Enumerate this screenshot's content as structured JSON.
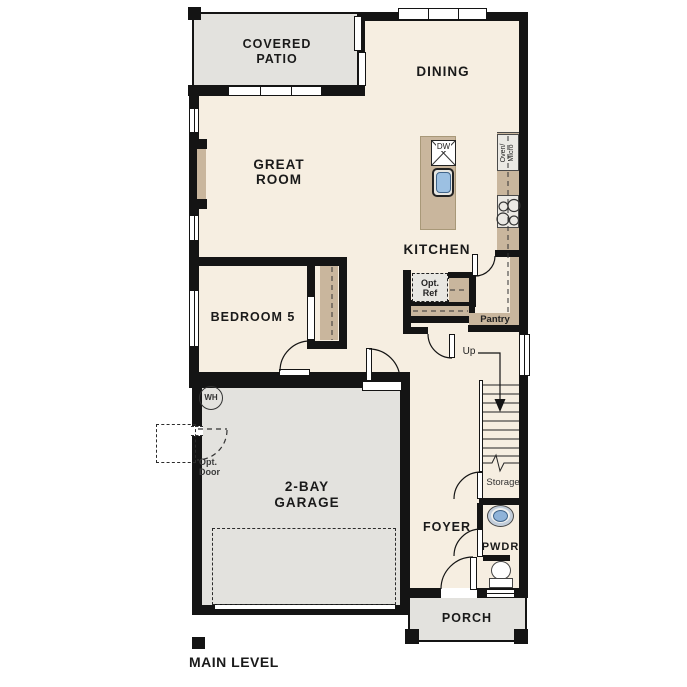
{
  "plan": {
    "title": "MAIN LEVEL",
    "rooms": {
      "covered_patio_1": "COVERED",
      "covered_patio_2": "PATIO",
      "dining": "DINING",
      "great_room_1": "GREAT",
      "great_room_2": "ROOM",
      "kitchen": "KITCHEN",
      "bedroom5": "BEDROOM 5",
      "garage_1": "2-BAY",
      "garage_2": "GARAGE",
      "foyer": "FOYER",
      "pwdr": "PWDR",
      "porch": "PORCH"
    },
    "features": {
      "pantry": "Pantry",
      "storage": "Storage",
      "up": "Up",
      "water_heater": "WH",
      "dishwasher": "DW",
      "oven_micro_1": "Oven/",
      "oven_micro_2": "Micro",
      "opt_ref_1": "Opt.",
      "opt_ref_2": "Ref",
      "opt_door_1": "Opt.",
      "opt_door_2": "Door"
    },
    "colors": {
      "floor": "#f6eee1",
      "outdoor_gray": "#e3e2de",
      "wall": "#141414",
      "cabinet_tan": "#c9b69d",
      "fixture_blue": "#9cc0e2",
      "appliance_gray": "#ebe9e4"
    }
  }
}
